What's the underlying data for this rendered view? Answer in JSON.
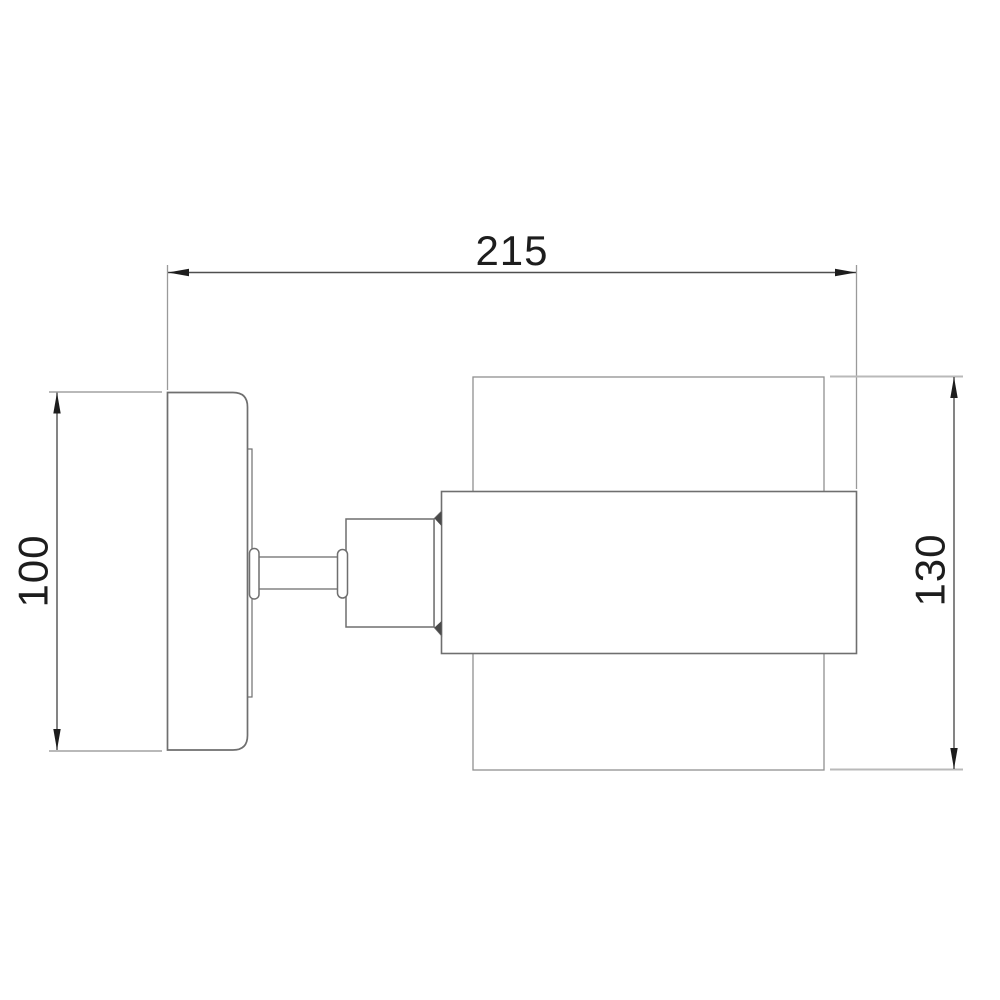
{
  "page": {
    "background": "#ffffff",
    "description": "Technical dimension drawing of a wall sconce lamp, side view"
  },
  "drawing": {
    "colors": {
      "object_line": "#6f6f6f",
      "thin_object_line": "#909090",
      "extension_line": "#b9b9b9",
      "vertical_extension_line": "#9a9a9a",
      "dimension_line": "#4f4f4f",
      "arrow": "#1d1d1d",
      "text": "#1d1d1d",
      "cone_fill": "#4a4a4a",
      "fill": "#ffffff"
    },
    "dimensions": [
      {
        "id": "overall-depth",
        "label": "215",
        "orientation": "horizontal",
        "position": "top"
      },
      {
        "id": "backplate-height",
        "label": "100",
        "orientation": "vertical",
        "position": "left"
      },
      {
        "id": "shade-height",
        "label": "130",
        "orientation": "vertical",
        "position": "right"
      }
    ],
    "parts": [
      "wall-backplate",
      "mounting-strip",
      "pivot-pill",
      "arm",
      "arm-pill",
      "lamp-holder",
      "holder-cone",
      "shade-band",
      "shade-glass"
    ]
  }
}
